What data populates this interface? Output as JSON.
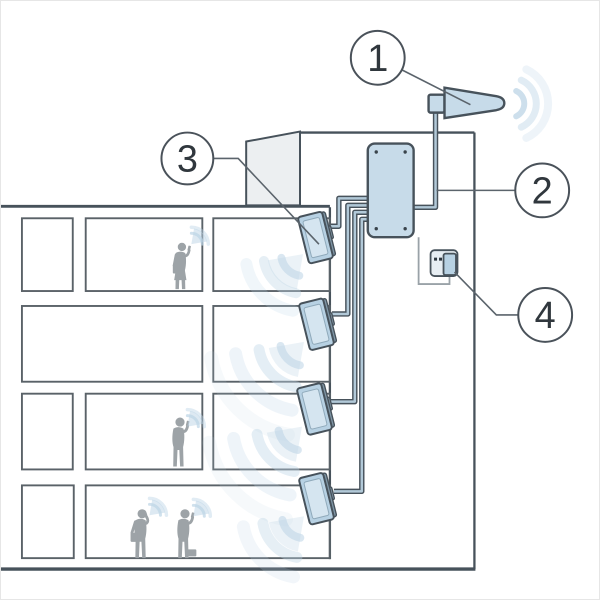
{
  "figure": {
    "kind": "technical-diagram",
    "subject": "in-building-cellular-repeater-system",
    "callouts": [
      {
        "number": "1",
        "target": "outdoor-antenna"
      },
      {
        "number": "2",
        "target": "coaxial-feed-cable"
      },
      {
        "number": "3",
        "target": "indoor-panel-antenna"
      },
      {
        "number": "4",
        "target": "power-outlet"
      }
    ],
    "counts": {
      "floors": 4,
      "indoor_antennas": 4,
      "people": 4
    },
    "colors": {
      "line": "#47525b",
      "room-line": "#5a6268",
      "panel": "#c7dbe9",
      "panel-dark": "#b7d1e3",
      "panel-inner": "#d5e5f0",
      "cable-fill": "#b2c9d8",
      "arc": "#bcd4e6",
      "person": "#9da3a7",
      "roof": "#eceff1",
      "leader": "#5b646c",
      "text": "#30373d",
      "bg": "#ffffff"
    }
  }
}
